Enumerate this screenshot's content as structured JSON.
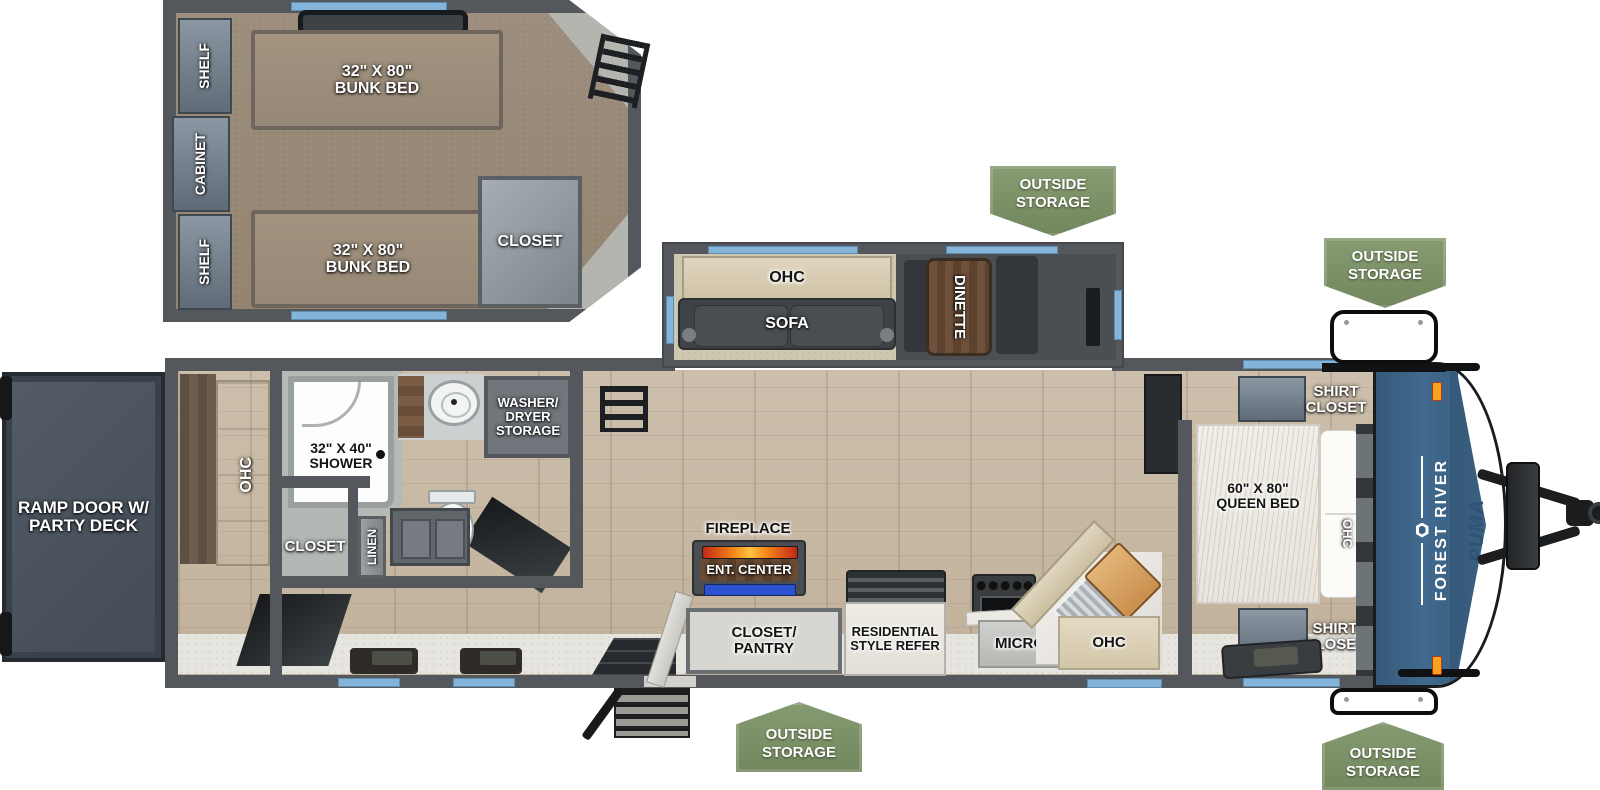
{
  "colors": {
    "wall_gray": "#54585c",
    "window_blue": "#84b4da",
    "badge_green": "#7d9266",
    "cap_blue": "#3c6384",
    "puma_text": "#2e5374",
    "flame_orange": "#f08018",
    "ent_center_blue": "#2c53cf",
    "floor_wood": "#c6b7a2"
  },
  "badges": {
    "outside_storage": "OUTSIDE STORAGE"
  },
  "bunk_room": {
    "shelf_top": "SHELF",
    "cabinet": "CABINET",
    "shelf_bottom": "SHELF",
    "bunk_top": {
      "size": "32\" X 80\"",
      "name": "BUNK BED"
    },
    "bunk_bottom": {
      "size": "32\" X 80\"",
      "name": "BUNK BED"
    },
    "closet": "CLOSET"
  },
  "garage": {
    "ramp_door": "RAMP DOOR W/ PARTY DECK",
    "ohc": "OHC"
  },
  "bathroom": {
    "shower": {
      "size": "32\" X 40\"",
      "name": "SHOWER"
    },
    "closet": "CLOSET",
    "linen": "LINEN",
    "washer_dryer": "WASHER/ DRYER STORAGE"
  },
  "living": {
    "ohc": "OHC",
    "sofa": "SOFA",
    "dinette": "DINETTE"
  },
  "kitchen": {
    "fireplace": "FIREPLACE",
    "ent_center": "ENT. CENTER",
    "closet_pantry": "CLOSET/ PANTRY",
    "refer": "RESIDENTIAL STYLE REFER",
    "micro": "MICRO",
    "ohc": "OHC"
  },
  "bedroom": {
    "queen_bed": {
      "size": "60\" X 80\"",
      "name": "QUEEN BED"
    },
    "shirt_closet_top": "SHIRT CLOSET",
    "shirt_closet_bottom": "SHIRT CLOSET",
    "ohc": "OHC"
  },
  "brand": {
    "maker": "FOREST RIVER",
    "model": "PUMA"
  }
}
